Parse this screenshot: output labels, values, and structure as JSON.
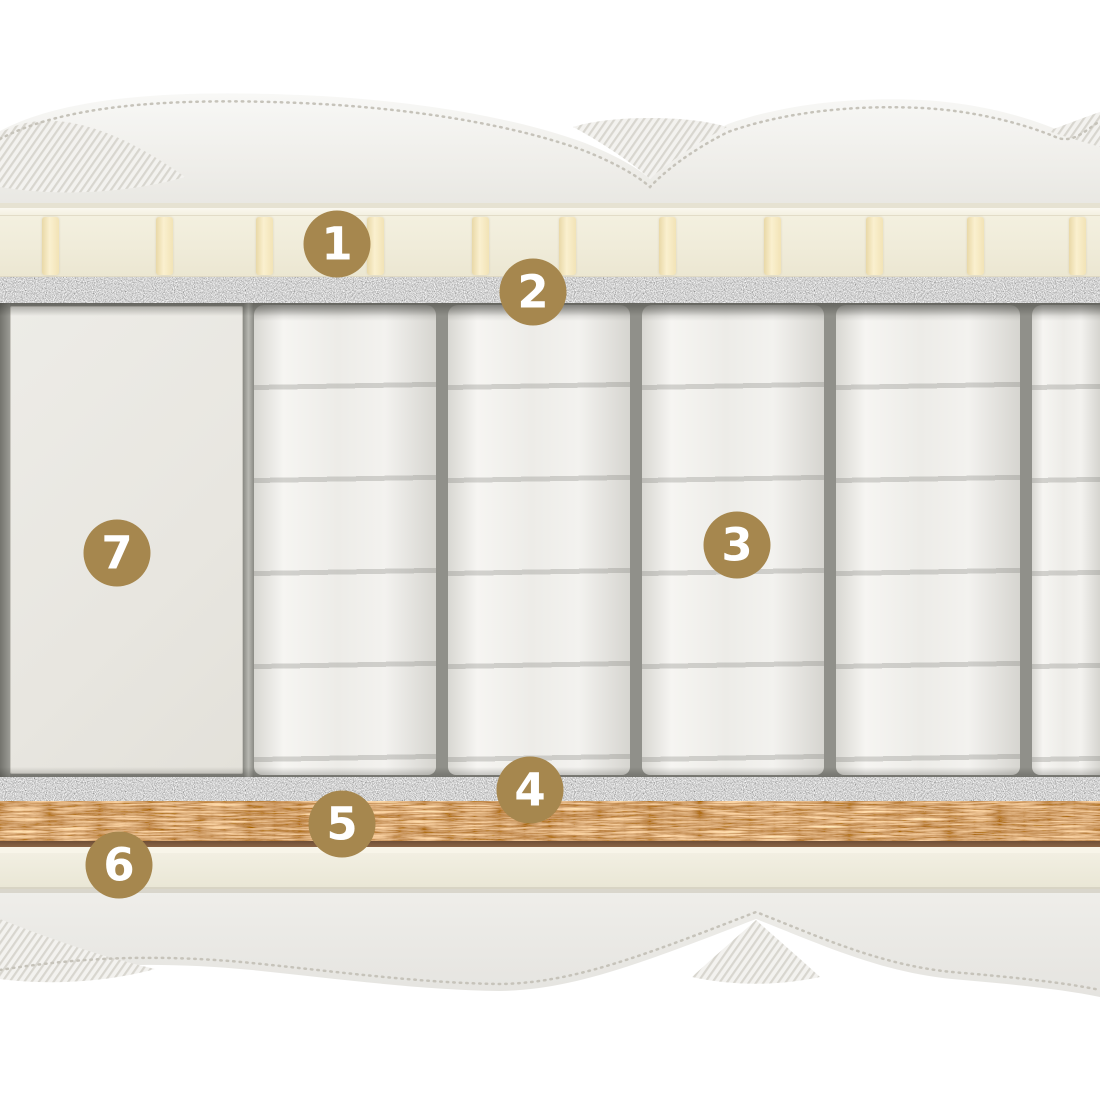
{
  "badges": [
    {
      "label": "1"
    },
    {
      "label": "2"
    },
    {
      "label": "3"
    },
    {
      "label": "4"
    },
    {
      "label": "5"
    },
    {
      "label": "6"
    },
    {
      "label": "7"
    }
  ],
  "colors": {
    "badge": "#A6874E",
    "badge_text": "#FFFFFF",
    "latex": "#F0ECDA",
    "slat": "#F7ECC9",
    "felt": "#8C8C86",
    "coir": "#CE9A62",
    "coir_line": "#6E4E36",
    "base_foam": "#F0EDE0",
    "cover": "#F1F0EC",
    "springs_bg": "#90908A",
    "spring": "#F2F1EE",
    "edge_foam": "#E9E7E1"
  }
}
